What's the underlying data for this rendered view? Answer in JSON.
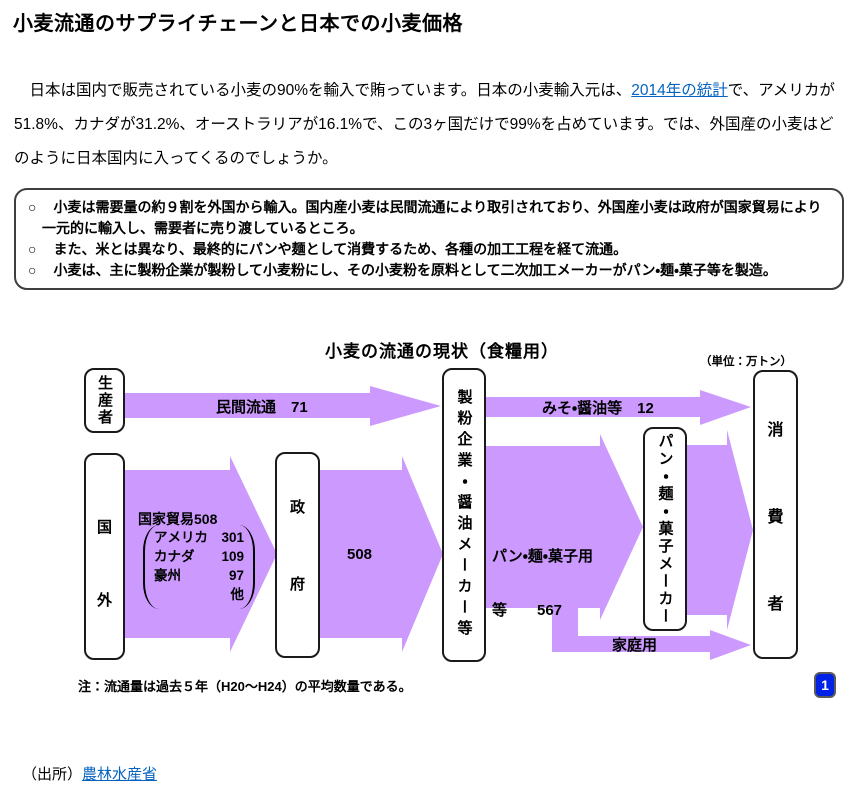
{
  "colors": {
    "arrow_purple": "#CC99FF",
    "link_blue": "#0563C1",
    "badge_blue": "#0021E6"
  },
  "article": {
    "title": "小麦流通のサプライチェーンと日本での小麦価格",
    "intro": {
      "before": "　日本は国内で販売されている小麦の90%を輸入で賄っています。日本の小麦輸入元は、",
      "link": "2014年の統計",
      "after": "で、アメリカが51.8%、カナダが31.2%、オーストラリアが16.1%で、この3ヶ国だけで99%を占めています。では、外国産の小麦はどのように日本国内に入ってくるのでしょうか。"
    },
    "summary_bullets": [
      {
        "marker": "○",
        "text": "小麦は需要量の約９割を外国から輸入。国内産小麦は民間流通により取引されており、外国産小麦は政府が国家貿易により一元的に輸入し、需要者に売り渡しているところ。"
      },
      {
        "marker": "○",
        "text": "また、米とは異なり、最終的にパンや麺として消費するため、各種の加工工程を経て流通。"
      },
      {
        "marker": "○",
        "text": "小麦は、主に製粉企業が製粉して小麦粉にし、その小麦粉を原料として二次加工メーカーがパン・麺・菓子等を製造。"
      }
    ],
    "source": {
      "prefix": "（出所）",
      "link": "農林水産省"
    }
  },
  "diagram": {
    "title": "小麦の流通の現状（食糧用）",
    "unit_label": "（単位：万トン）",
    "boxes": {
      "producers": "生産者",
      "overseas": {
        "chars": [
          "国",
          "外"
        ]
      },
      "government": {
        "chars": [
          "政",
          "府"
        ]
      },
      "millers": "製粉企業・醤油メーカー等",
      "secondary_makers": "パン・麺・菓子メーカー",
      "consumers": {
        "chars": [
          "消",
          "費",
          "者"
        ]
      }
    },
    "flows": {
      "private_distribution": "民間流通　71",
      "state_trade": "国家貿易508",
      "state_trade_breakdown": [
        {
          "name": "アメリカ",
          "value": "301"
        },
        {
          "name": "カナダ",
          "value": "109"
        },
        {
          "name": "豪州",
          "value": "97"
        },
        {
          "name": "",
          "value": "他"
        }
      ],
      "gov_to_millers": "508",
      "miso_soy": "みそ・醤油等　12",
      "bread_noodle_line1": "パン・麺・菓子用",
      "bread_noodle_line2": "等　　567",
      "household": "家庭用"
    },
    "note": "注：流通量は過去５年（H20～H24）の平均数量である。",
    "page_badge": "1"
  }
}
